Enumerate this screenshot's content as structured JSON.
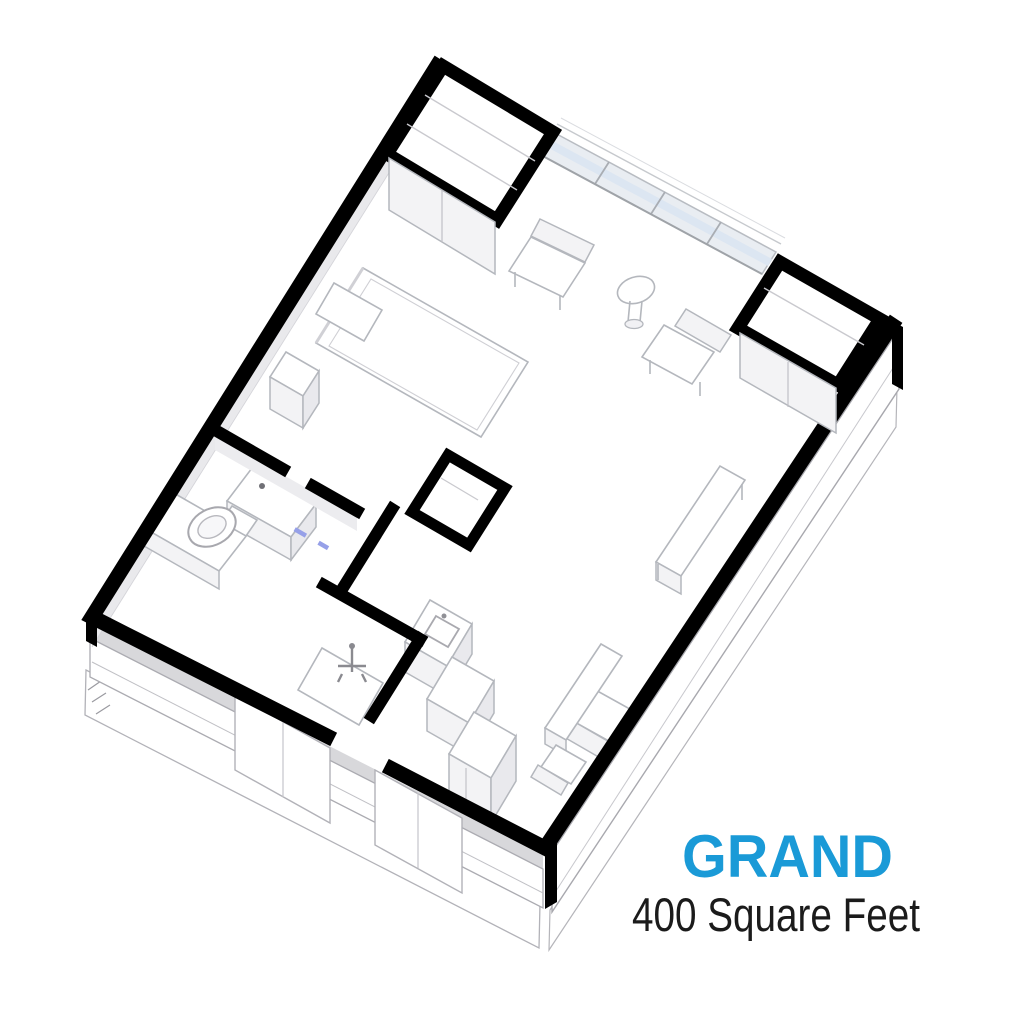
{
  "page": {
    "background": "#ffffff"
  },
  "label": {
    "name": "GRAND",
    "name_color": "#1A9AD7",
    "area": "400 Square Feet",
    "area_color": "#1B1B1B"
  },
  "floorplan": {
    "type": "3d-isometric-unit-cutaway",
    "wall_color": "#000000",
    "furniture_stroke": "#B4B7BD",
    "glazing_color": "#DCE6F2",
    "door_mark_color": "#96A0E8",
    "elements": [
      "exterior-walls",
      "window-wall",
      "entry-closet",
      "corner-closet",
      "bed",
      "pillow",
      "nightstand",
      "lounge-chair-left",
      "lounge-chair-right",
      "round-side-table",
      "desk-upper",
      "desk-lower",
      "task-chair",
      "small-chair",
      "kitchen-pantry",
      "kitchen-sink-counter",
      "kitchen-base-cabinet",
      "kitchen-tall-cabinet",
      "bathroom-toilet",
      "bathroom-vanity",
      "shower",
      "entry-door-opening",
      "floor-slab"
    ]
  }
}
